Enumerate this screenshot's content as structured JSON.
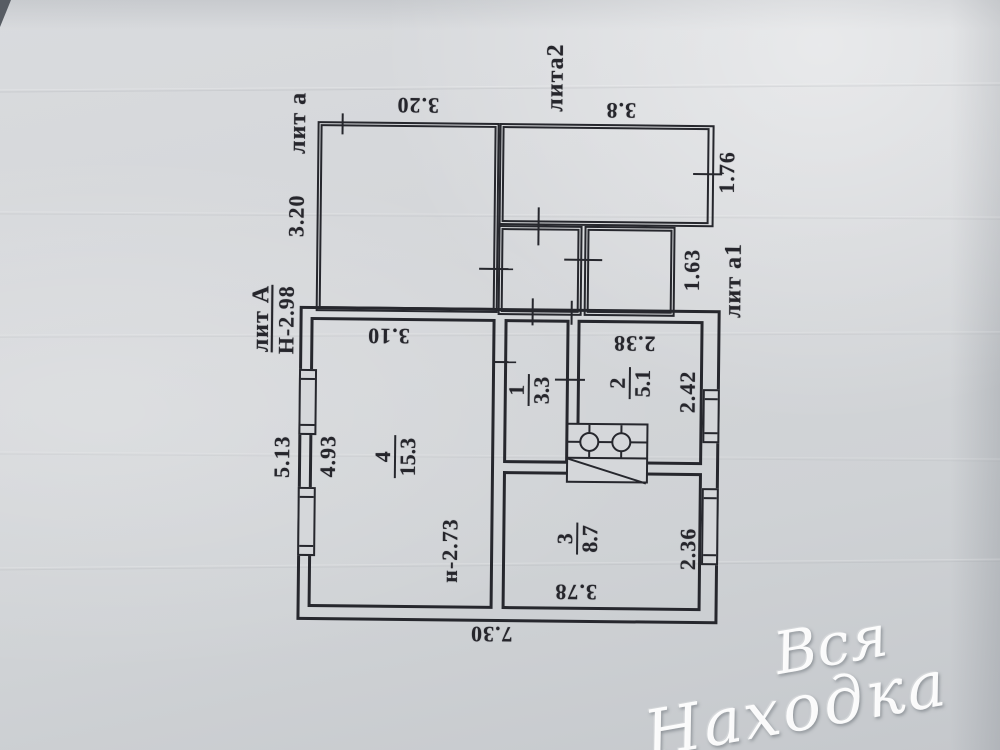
{
  "structures": {
    "veranda_label": "лит а",
    "lita2_label": "лита2",
    "a1_label": "лит а1",
    "main_label": "лит А",
    "main_ceiling_height": "Н-2.98",
    "room4_ceiling_height": "н-2.73"
  },
  "dimensions": {
    "veranda_width_top": "3.20",
    "veranda_height_left": "3.20",
    "lita2_width": "3.8",
    "lita2_height": "1.76",
    "a1_height": "1.63",
    "room4_width_top": "3.10",
    "house_height_outer": "5.13",
    "room4_height_inner": "4.93",
    "room2_width": "2.38",
    "room2_height": "2.42",
    "room3_width": "3.78",
    "room3_height": "2.36",
    "house_width_bottom": "7.30"
  },
  "rooms": [
    {
      "number": "1",
      "area": "3.3"
    },
    {
      "number": "2",
      "area": "5.1"
    },
    {
      "number": "3",
      "area": "8.7"
    },
    {
      "number": "4",
      "area": "15.3"
    }
  ],
  "watermark": {
    "line1": "Вся",
    "line2": "Находка"
  },
  "colors": {
    "ink": "#26272d",
    "paper": "#d4d6d9",
    "watermark": "#ffffff"
  }
}
